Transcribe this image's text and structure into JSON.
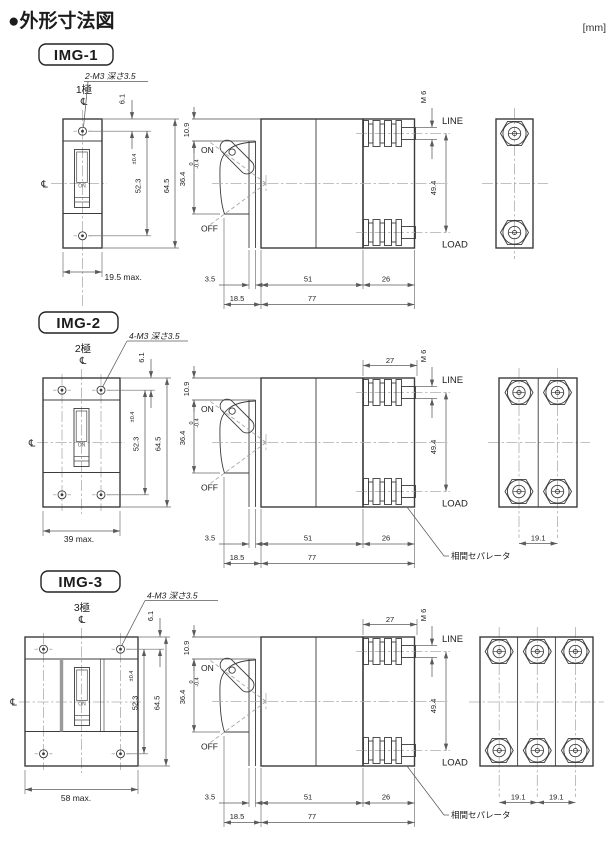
{
  "header": {
    "title": "●外形寸法図",
    "unit": "[mm]"
  },
  "sections": [
    {
      "badge": "IMG-1",
      "poles": "1極",
      "centerline_top": "℄",
      "centerline_left": "℄",
      "thread_note": "2-M3 深さ3.5",
      "front": {
        "toggle": "ON",
        "hole_offset": "6.1",
        "pitch": "52.3",
        "pitch_tol": "±0.4",
        "height": "64.5",
        "width_max": "19.5 max."
      },
      "side": {
        "rim_height": "10.9",
        "window_height": "36.4",
        "window_tol_upper": "0",
        "window_tol_lower": "-0.4",
        "on_label": "ON",
        "off_label": "OFF",
        "escutcheon_depth": "3.5",
        "body_depth": "51",
        "terminal_depth": "26",
        "front_depth": "18.5",
        "total_depth": "77",
        "screw": "M 6",
        "line_label": "LINE",
        "load_label": "LOAD",
        "terminal_pitch": "49.4"
      }
    },
    {
      "badge": "IMG-2",
      "poles": "2極",
      "centerline_top": "℄",
      "centerline_left": "℄",
      "thread_note": "4-M3 深さ3.5",
      "front": {
        "toggle": "ON",
        "hole_offset": "6.1",
        "pitch": "52.3",
        "pitch_tol": "±0.4",
        "height": "64.5",
        "width_max": "39 max."
      },
      "side": {
        "rim_height": "10.9",
        "window_height": "36.4",
        "window_tol_upper": "0",
        "window_tol_lower": "-0.4",
        "on_label": "ON",
        "off_label": "OFF",
        "escutcheon_depth": "3.5",
        "body_depth": "51",
        "terminal_depth": "26",
        "front_depth": "18.5",
        "total_depth": "77",
        "screw": "M 6",
        "line_label": "LINE",
        "load_label": "LOAD",
        "terminal_pitch": "49.4",
        "block_width": "27",
        "separator_note": "相間セパレータ"
      },
      "end": {
        "pole_pitch": "19.1"
      }
    },
    {
      "badge": "IMG-3",
      "poles": "3極",
      "centerline_top": "℄",
      "centerline_left": "℄",
      "thread_note": "4-M3 深さ3.5",
      "front": {
        "toggle": "ON",
        "hole_offset": "6.1",
        "pitch": "52.3",
        "pitch_tol": "±0.4",
        "height": "64.5",
        "width_max": "58 max."
      },
      "side": {
        "rim_height": "10.9",
        "window_height": "36.4",
        "window_tol_upper": "0",
        "window_tol_lower": "-0.4",
        "on_label": "ON",
        "off_label": "OFF",
        "escutcheon_depth": "3.5",
        "body_depth": "51",
        "terminal_depth": "26",
        "front_depth": "18.5",
        "total_depth": "77",
        "screw": "M 6",
        "line_label": "LINE",
        "load_label": "LOAD",
        "terminal_pitch": "49.4",
        "block_width": "27",
        "separator_note": "相間セパレータ"
      },
      "end": {
        "pole_pitch_1": "19.1",
        "pole_pitch_2": "19.1"
      }
    }
  ]
}
